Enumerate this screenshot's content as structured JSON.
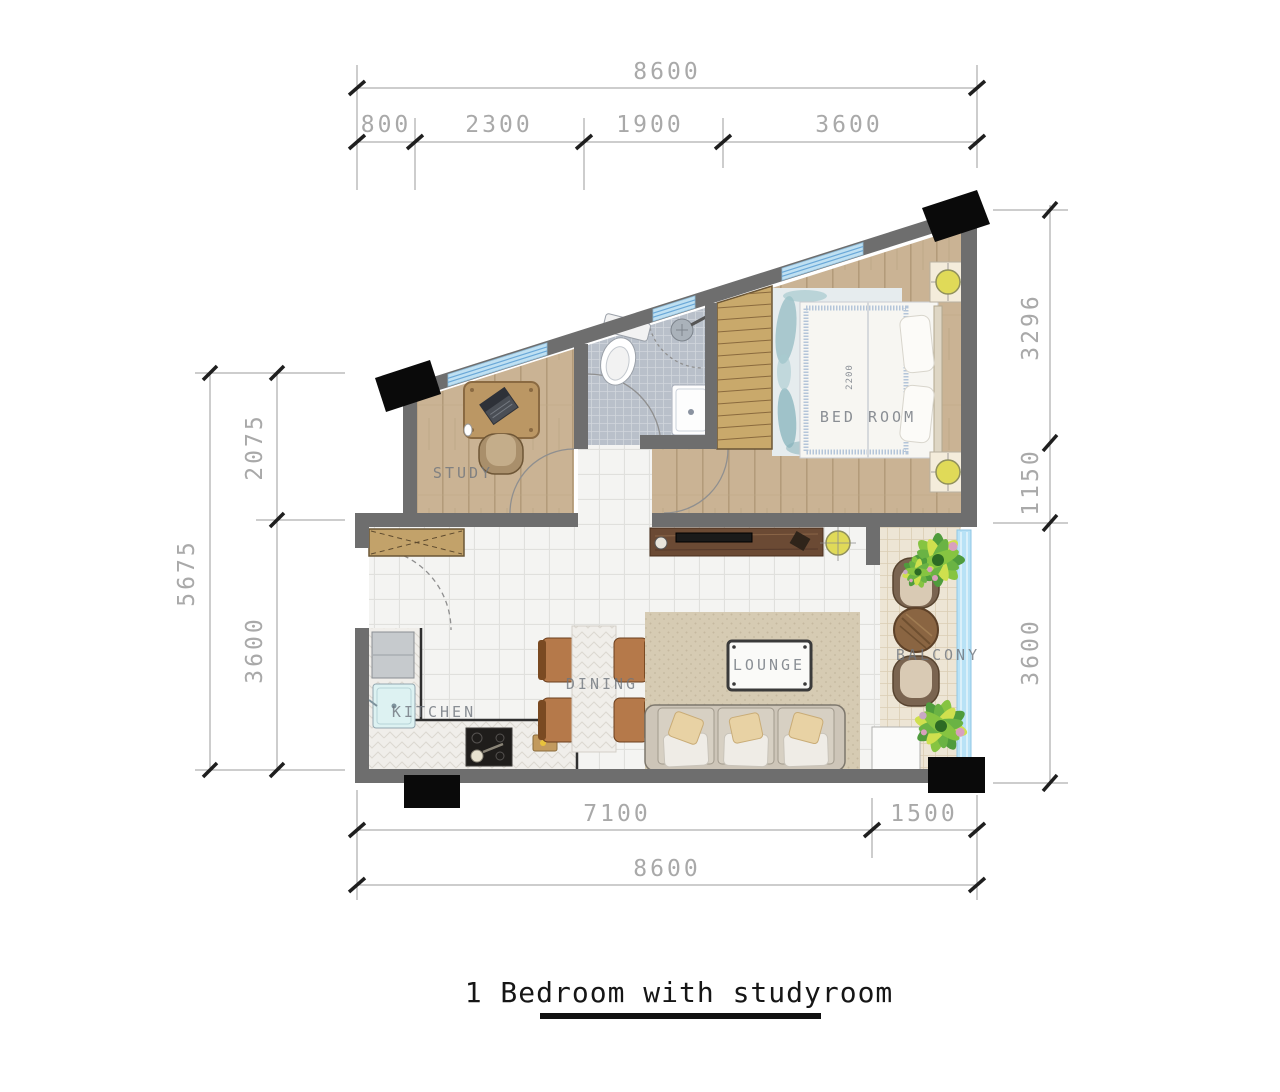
{
  "title": {
    "text": "1 Bedroom with studyroom"
  },
  "dimensions": {
    "top": {
      "total": "8600",
      "seg1": "800",
      "seg2": "2300",
      "seg3": "1900",
      "seg4": "3600"
    },
    "right": {
      "seg1": "3296",
      "seg2": "1150",
      "seg3": "3600"
    },
    "left": {
      "total": "5675",
      "seg1": "2075",
      "seg2": "3600"
    },
    "bottom": {
      "seg1": "7100",
      "seg2": "1500",
      "total": "8600"
    }
  },
  "rooms": {
    "study": "STUDY",
    "bedroom": "BED ROOM",
    "bed_width": "2200",
    "kitchen": "KITCHEN",
    "dining": "DINING",
    "lounge": "LOUNGE",
    "balcony": "BALCONY"
  },
  "colors": {
    "wall": "#6e6e6e",
    "window_glass": "#bfe0f2",
    "wood_floor": "#cab394",
    "white_tile": "#f4f4f2",
    "bath_tile": "#b9c0ca",
    "balcony_tile": "#ede5d5",
    "dim_text": "#a9a9a9",
    "lamp_accent": "#e0da58",
    "marker_black": "#0a0a0a"
  }
}
